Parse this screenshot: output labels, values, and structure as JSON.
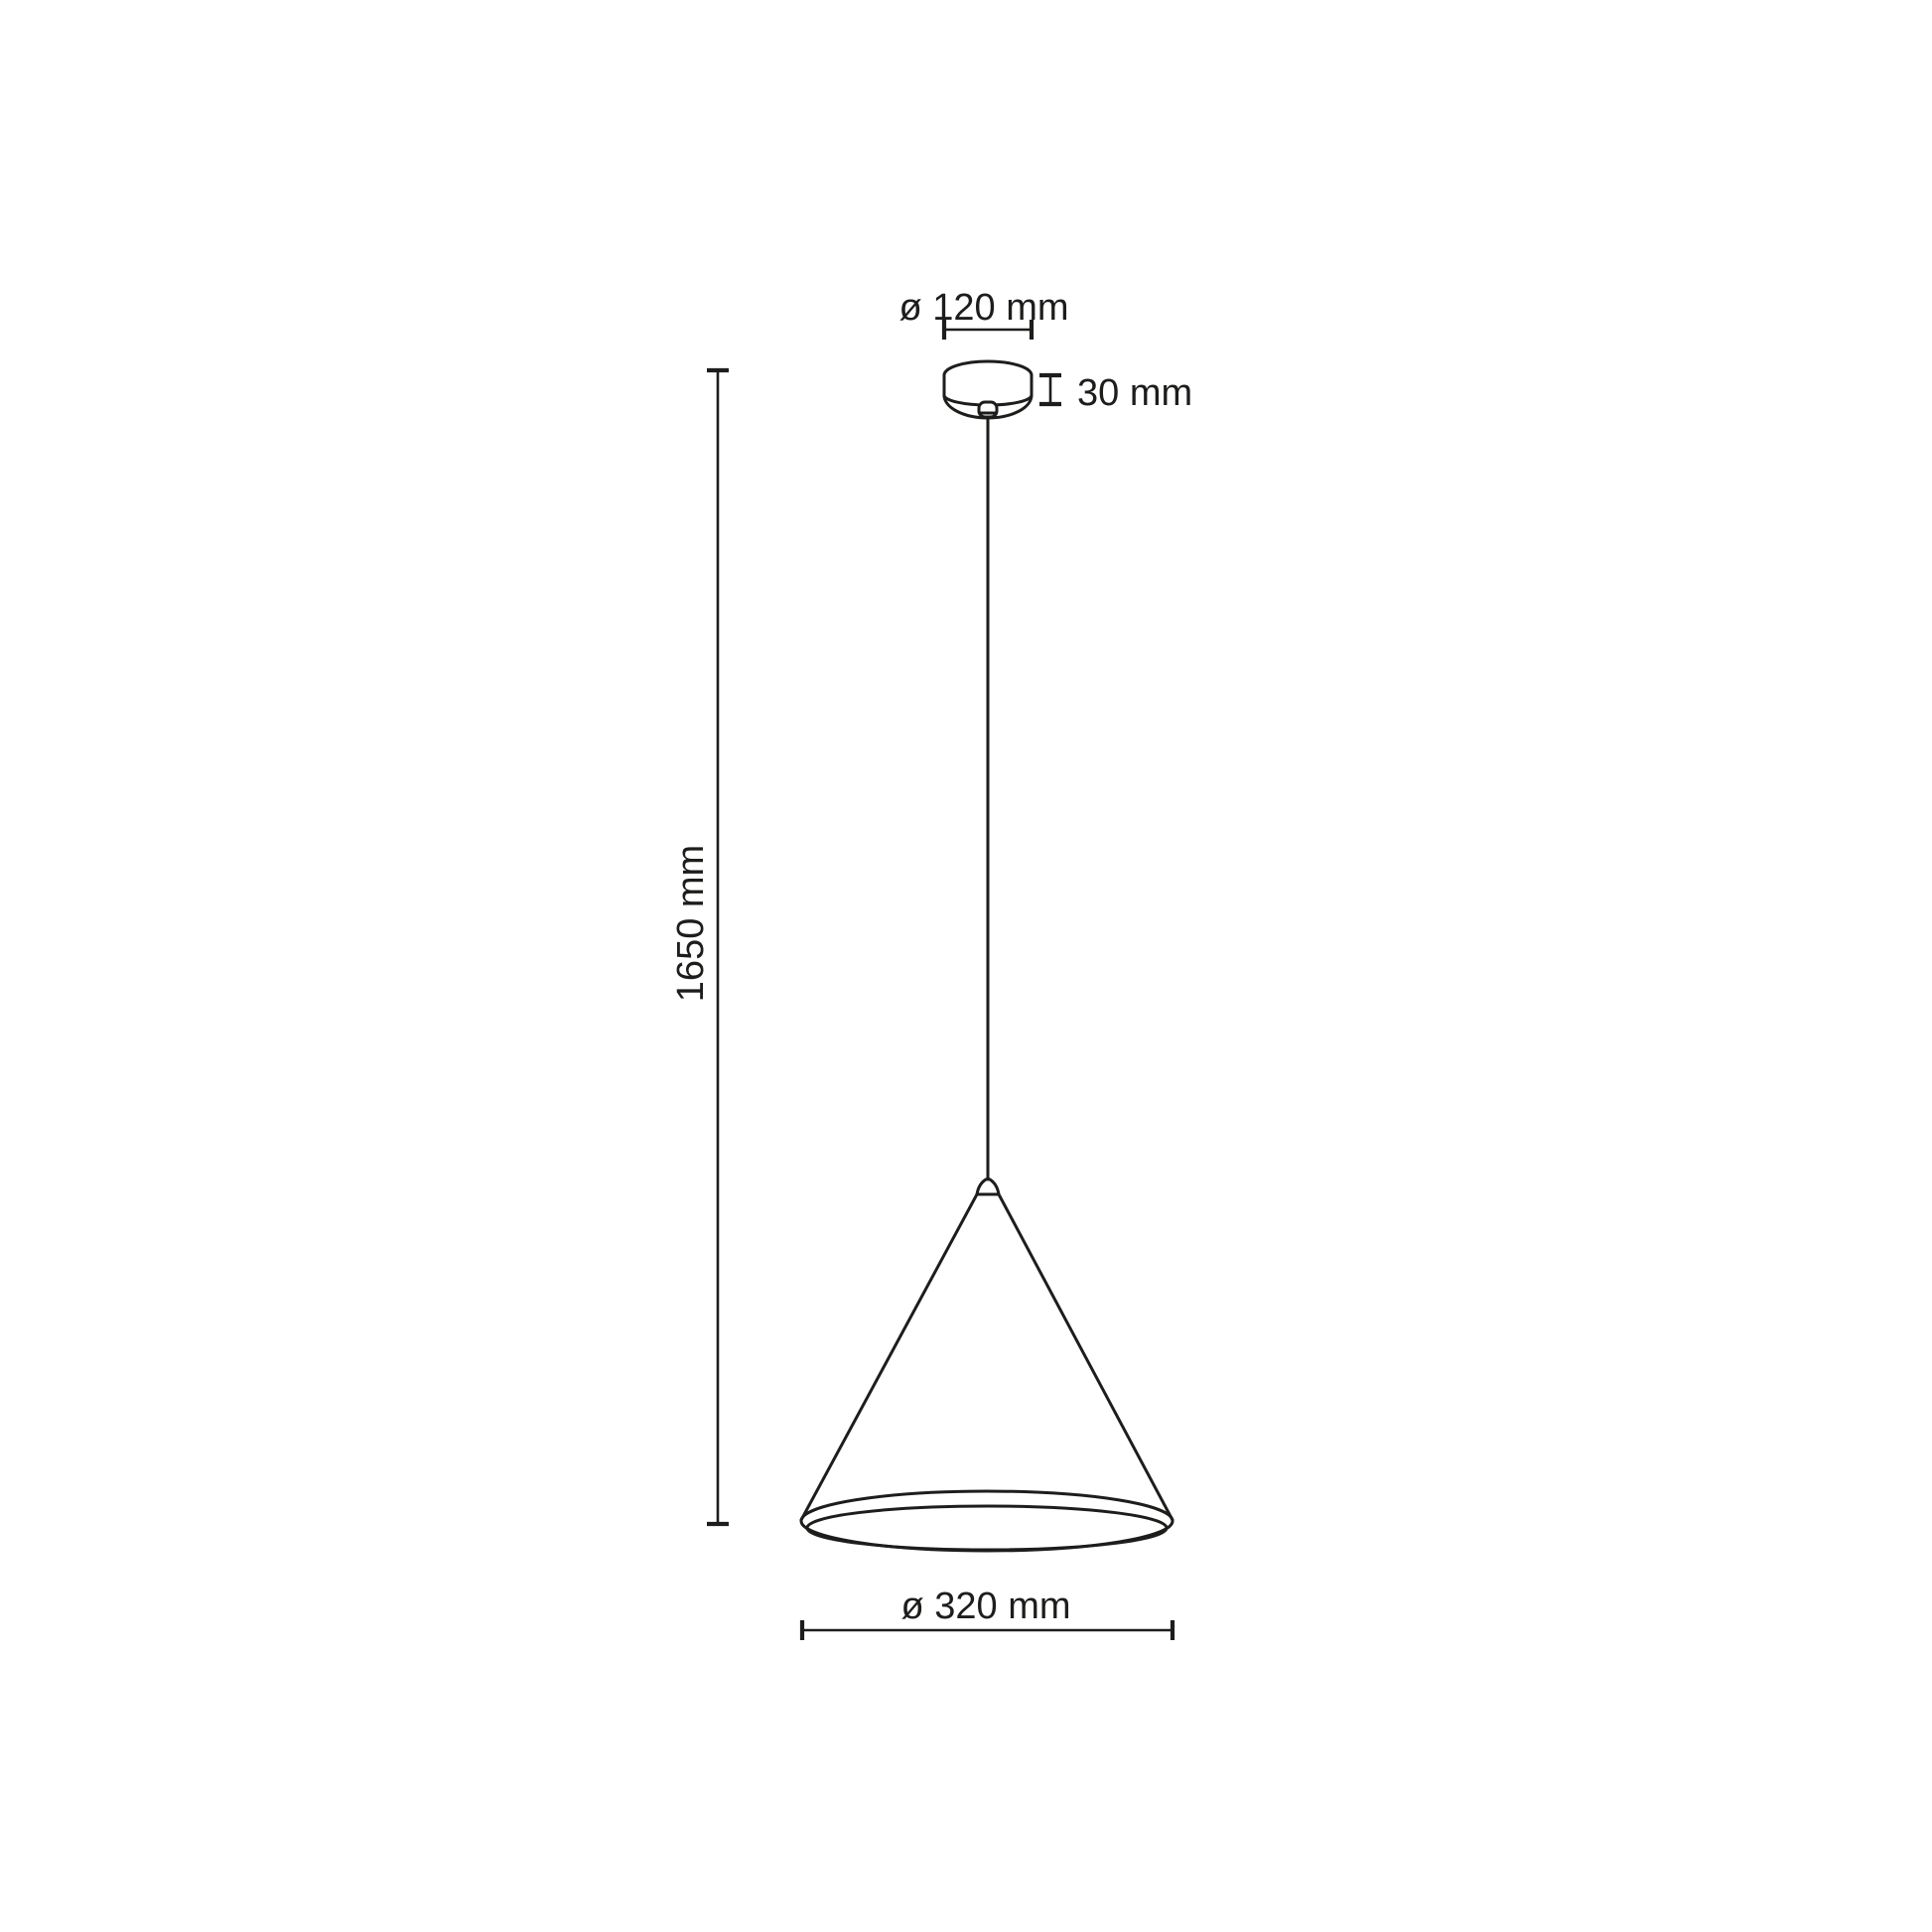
{
  "page": {
    "background": "#ffffff",
    "line_color": "#1d1d1b"
  },
  "drawing": {
    "type": "technical dimension diagram",
    "subject": "cone pendant lamp with ceiling canopy and suspension cord",
    "labels": {
      "canopy_diameter": "ø 120 mm",
      "canopy_height": "30 mm",
      "suspension_height": "1650 mm",
      "shade_diameter": "ø 320 mm"
    },
    "dimensions_mm": {
      "canopy_diameter": 120,
      "canopy_height": 30,
      "suspension_height": 1650,
      "shade_diameter": 320
    }
  }
}
